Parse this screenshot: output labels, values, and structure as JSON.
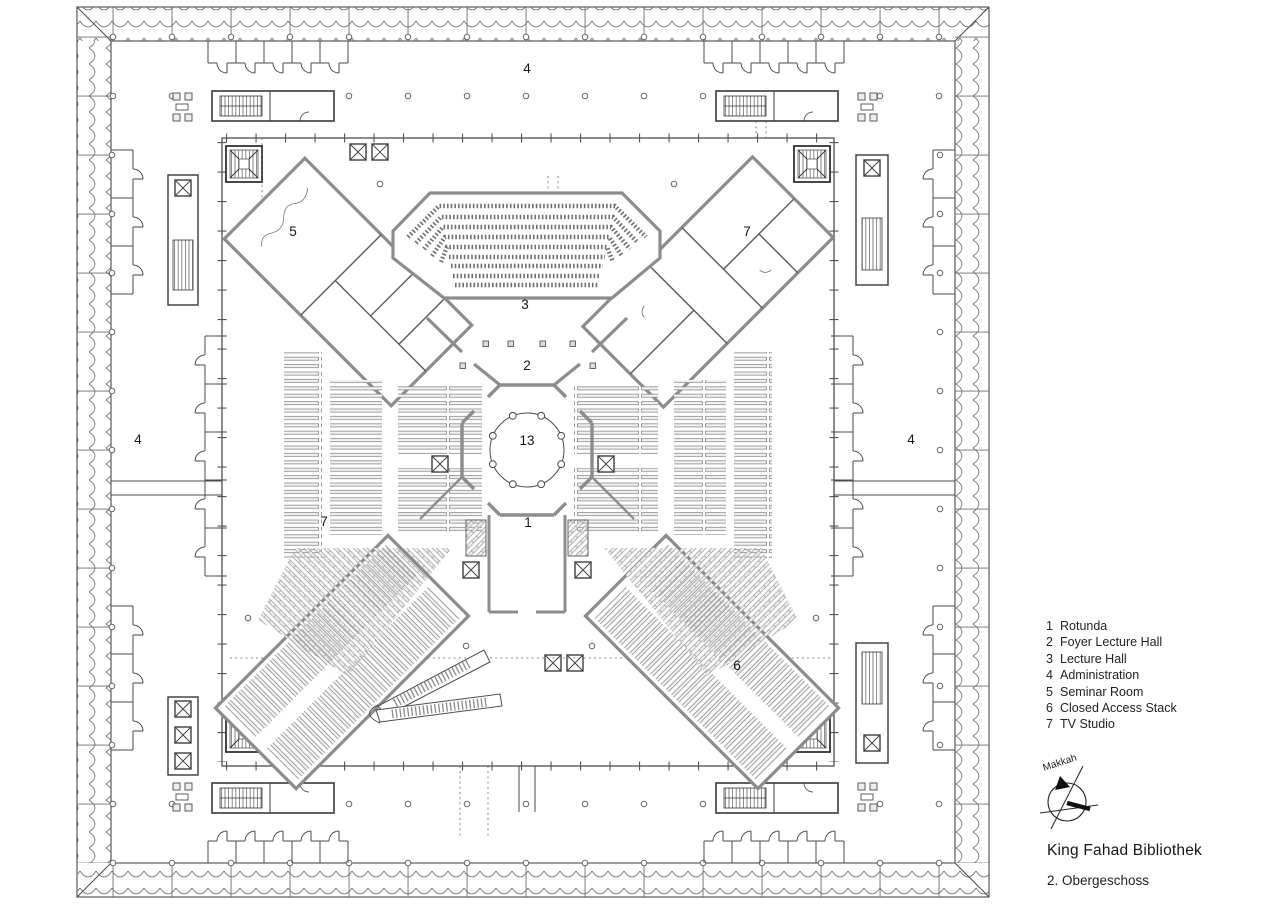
{
  "document": {
    "type": "architectural floor plan",
    "colors": {
      "background": "#ffffff",
      "line": "#474747",
      "wall_gray": "#8c8c8c",
      "text": "#1c1c1c"
    }
  },
  "plan": {
    "labels": {
      "admin_north": "4",
      "admin_west": "4",
      "admin_east": "4",
      "seminar_room": "5",
      "tv_studio": "7",
      "lecture_hall": "3",
      "foyer_lecture_hall": "2",
      "rotunda_void": "13",
      "rotunda": "1",
      "stack_west": "7",
      "closed_access_stack": "6"
    }
  },
  "legend": {
    "items": [
      {
        "num": "1",
        "label": "Rotunda"
      },
      {
        "num": "2",
        "label": "Foyer Lecture Hall"
      },
      {
        "num": "3",
        "label": "Lecture Hall"
      },
      {
        "num": "4",
        "label": "Administration"
      },
      {
        "num": "5",
        "label": "Seminar Room"
      },
      {
        "num": "6",
        "label": "Closed Access Stack"
      },
      {
        "num": "7",
        "label": "TV Studio"
      }
    ]
  },
  "compass": {
    "label": "Makkah"
  },
  "titleblock": {
    "title": "King Fahad Bibliothek",
    "subtitle": "2. Obergeschoss"
  }
}
